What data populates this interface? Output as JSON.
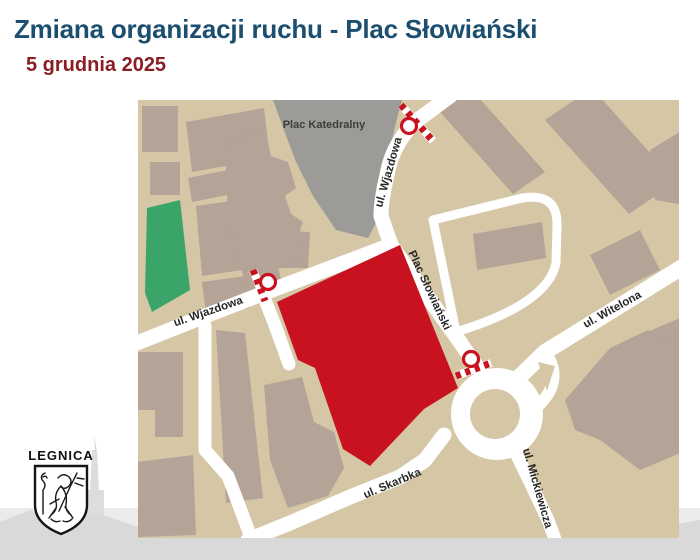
{
  "header": {
    "title": "Zmiana organizacji ruchu - Plac Słowiański",
    "date": "5 grudnia 2025",
    "title_color": "#1C4E6F",
    "date_color": "#8B1E24"
  },
  "map": {
    "labels": {
      "plac_katedralny": "Plac Katedralny",
      "wjazdowa_vertical": "ul. Wjazdowa",
      "wjazdowa_horizontal": "ul. Wjazdowa",
      "plac_slowianski": "Plac Słowiański",
      "witelona": "ul. Witelona",
      "skarbka": "ul. Skarbka",
      "mickiewicza": "ul. Mickiewicza"
    },
    "legend": {
      "closed_area_color": "#C9121F",
      "green_area_color": "#3AA469",
      "square_color": "#9C9B97",
      "ground_color": "#D5C7A5",
      "building_color": "#B4A397",
      "road_color": "#FFFFFF",
      "closure_marker_color": "#C9121F",
      "closure_markers_count": "3"
    }
  },
  "footer": {
    "logo_text": "LEGNICA"
  }
}
